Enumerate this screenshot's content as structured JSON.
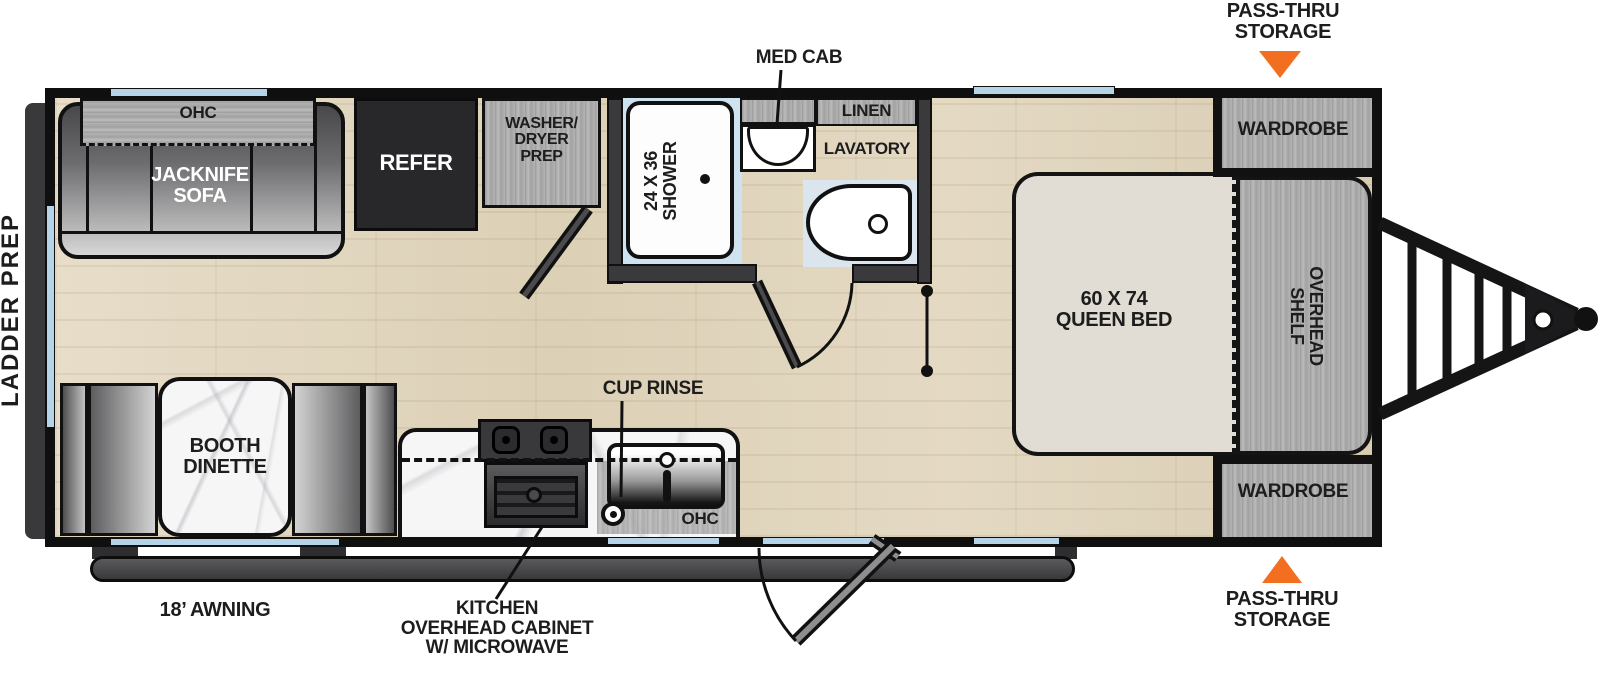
{
  "plan_title": "Travel trailer floor plan",
  "labels": {
    "ladder_prep": "LADDER PREP",
    "pass_thru_top": "PASS-THRU\nSTORAGE",
    "pass_thru_bottom": "PASS-THRU\nSTORAGE",
    "med_cab": "MED CAB",
    "cup_rinse": "CUP RINSE",
    "awning": "18’ AWNING",
    "kitchen_ohc": "KITCHEN\nOVERHEAD CABINET\nW/ MICROWAVE"
  },
  "rooms": {
    "ohc_sofa": "OHC",
    "jacknife_sofa": "JACKNIFE\nSOFA",
    "refer": "REFER",
    "washer_dryer": "WASHER/\nDRYER\nPREP",
    "shower": "24 X 36\nSHOWER",
    "linen": "LINEN",
    "lavatory": "LAVATORY",
    "wardrobe_top": "WARDROBE",
    "wardrobe_bottom": "WARDROBE",
    "queen_bed": "60 X 74\nQUEEN BED",
    "overhead_shelf": "OVERHEAD\nSHELF",
    "booth_dinette": "BOOTH\nDINETTE",
    "ohc_kitchen": "OHC"
  },
  "colors": {
    "accent_orange": "#f26f21",
    "window_blue": "#b6d4e8",
    "wall_black": "#101010",
    "cabinet_gray": "#ababab",
    "floor_wood": "#ddd2ba",
    "marble_white": "#f6f6f6",
    "awning_gray": "#4a4a4c",
    "appliance_dark": "#28282a"
  }
}
